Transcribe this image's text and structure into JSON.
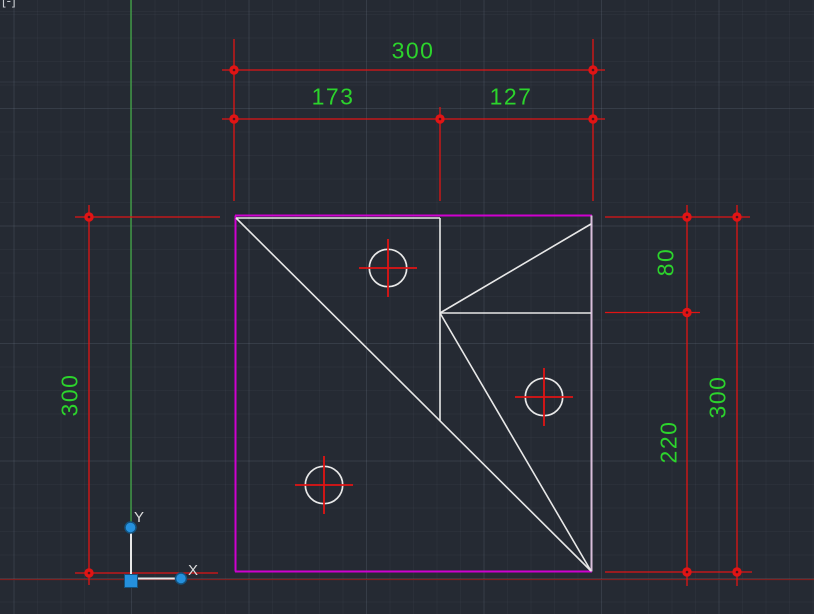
{
  "viewport": {
    "controls_fragment": "[-]"
  },
  "dimensions": {
    "top_width": {
      "value": "300"
    },
    "top_seg_left": {
      "value": "173"
    },
    "top_seg_right": {
      "value": "127"
    },
    "left_total": {
      "value": "300"
    },
    "right_upper": {
      "value": "80"
    },
    "right_lower": {
      "value": "220"
    },
    "right_total": {
      "value": "300"
    }
  },
  "ucs": {
    "x_label": "X",
    "y_label": "Y"
  },
  "colors": {
    "background": "#252a33",
    "dim_red": "#e11414",
    "dim_text_green": "#2cd42c",
    "axis_green": "#3f9e44",
    "axis_dark_red": "#7e2020",
    "plate_magenta": "#cf00cf",
    "plate_lavender": "#d9bedb",
    "geometry_white": "#e8e8e8",
    "ucs_blue": "#2590dd",
    "ucs_blue_dark": "#14527e"
  },
  "drawing": {
    "axes": {
      "y_axis": [
        131,
        0,
        131,
        529
      ],
      "x_axis": [
        0,
        579.5,
        814,
        579.5
      ]
    },
    "dimension_lines": [
      [
        222,
        70,
        605,
        70
      ],
      [
        222,
        119,
        605,
        119
      ],
      [
        234,
        39,
        234,
        201
      ],
      [
        440,
        107,
        440,
        201
      ],
      [
        593,
        39,
        593,
        201
      ],
      [
        89,
        205,
        89,
        585
      ],
      [
        75,
        217,
        220,
        217
      ],
      [
        75,
        573,
        218,
        573
      ],
      [
        687,
        205,
        687,
        586
      ],
      [
        737,
        205,
        737,
        586
      ],
      [
        605,
        217,
        750,
        217
      ],
      [
        605,
        312.5,
        700,
        312.5
      ],
      [
        605,
        572,
        752,
        572
      ]
    ],
    "dimension_dots": [
      [
        234,
        70
      ],
      [
        593,
        70
      ],
      [
        234,
        119
      ],
      [
        440,
        119
      ],
      [
        593,
        119
      ],
      [
        89,
        217
      ],
      [
        89,
        573
      ],
      [
        687,
        217
      ],
      [
        687,
        312.5
      ],
      [
        687,
        572
      ],
      [
        737,
        217
      ],
      [
        737,
        572
      ]
    ],
    "dot_radius": 4.7,
    "plate": {
      "magenta_edges": [
        [
          235,
          215.5,
          592,
          215.5
        ],
        [
          235.5,
          215.5,
          235.5,
          571.5
        ],
        [
          235,
          571.5,
          592,
          571.5
        ]
      ],
      "lavender_edge": [
        591.5,
        215.5,
        591.5,
        571.5
      ],
      "white_lines": [
        [
          236,
          218,
          440,
          218
        ],
        [
          440,
          218,
          440,
          421
        ],
        [
          236,
          218,
          591,
          571
        ],
        [
          440,
          313,
          591,
          224
        ],
        [
          440,
          313,
          591,
          313
        ],
        [
          440,
          313,
          591,
          571
        ]
      ]
    },
    "holes": [
      {
        "cx": 388,
        "cy": 268,
        "r": 18.7
      },
      {
        "cx": 544,
        "cy": 397,
        "r": 18.7
      },
      {
        "cx": 324,
        "cy": 485,
        "r": 18.7
      }
    ],
    "center_mark_half": 29,
    "ucs_icon": {
      "y_line": [
        131,
        533,
        131,
        574
      ],
      "x_line": [
        138,
        578.5,
        176,
        578.5
      ],
      "origin_square": [
        124.5,
        574.5,
        13,
        13
      ],
      "axis_dots": [
        [
          130.5,
          527.5
        ],
        [
          181,
          578.5
        ]
      ],
      "axis_dot_radius": 5.5,
      "y_label_pos": [
        139,
        522
      ],
      "x_label_pos": [
        193,
        575
      ]
    }
  }
}
